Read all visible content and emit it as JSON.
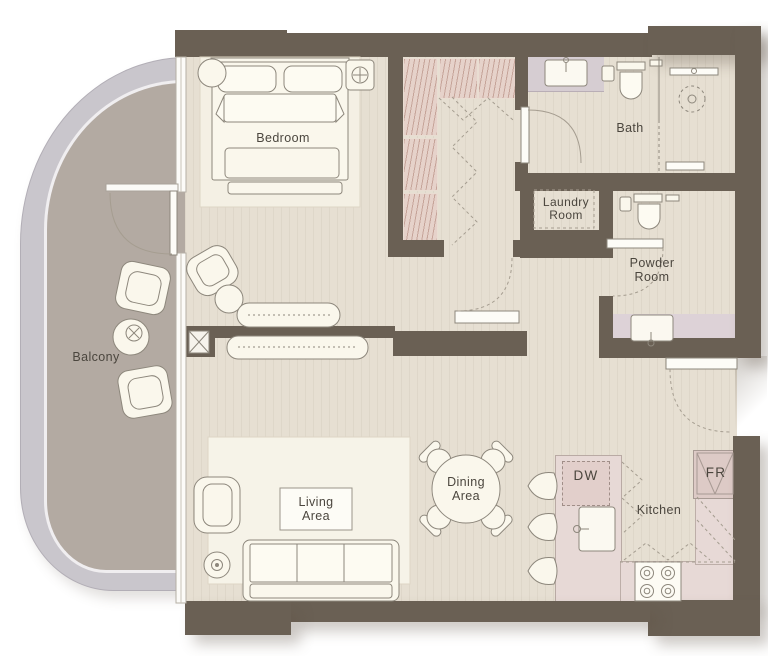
{
  "labels": {
    "bedroom": "Bedroom",
    "bath": "Bath",
    "laundry_line1": "Laundry",
    "laundry_line2": "Room",
    "powder_line1": "Powder",
    "powder_line2": "Room",
    "balcony": "Balcony",
    "living_line1": "Living",
    "living_line2": "Area",
    "dining_line1": "Dining",
    "dining_line2": "Area",
    "kitchen": "Kitchen",
    "dishwasher": "DW",
    "fridge": "FR"
  },
  "colors": {
    "wall": "#6a6054",
    "floor": "#e6dfd2",
    "balcony_floor": "#b3aaa2",
    "balcony_band": "#c9c6cc",
    "closet_rack": "#e6d2ca",
    "kitchen_counter": "#e7d9d6",
    "bath_vanity": "#d6cdd2",
    "furniture_fill": "#faf7ec",
    "outline": "#8d877c",
    "text": "#4b463e"
  }
}
